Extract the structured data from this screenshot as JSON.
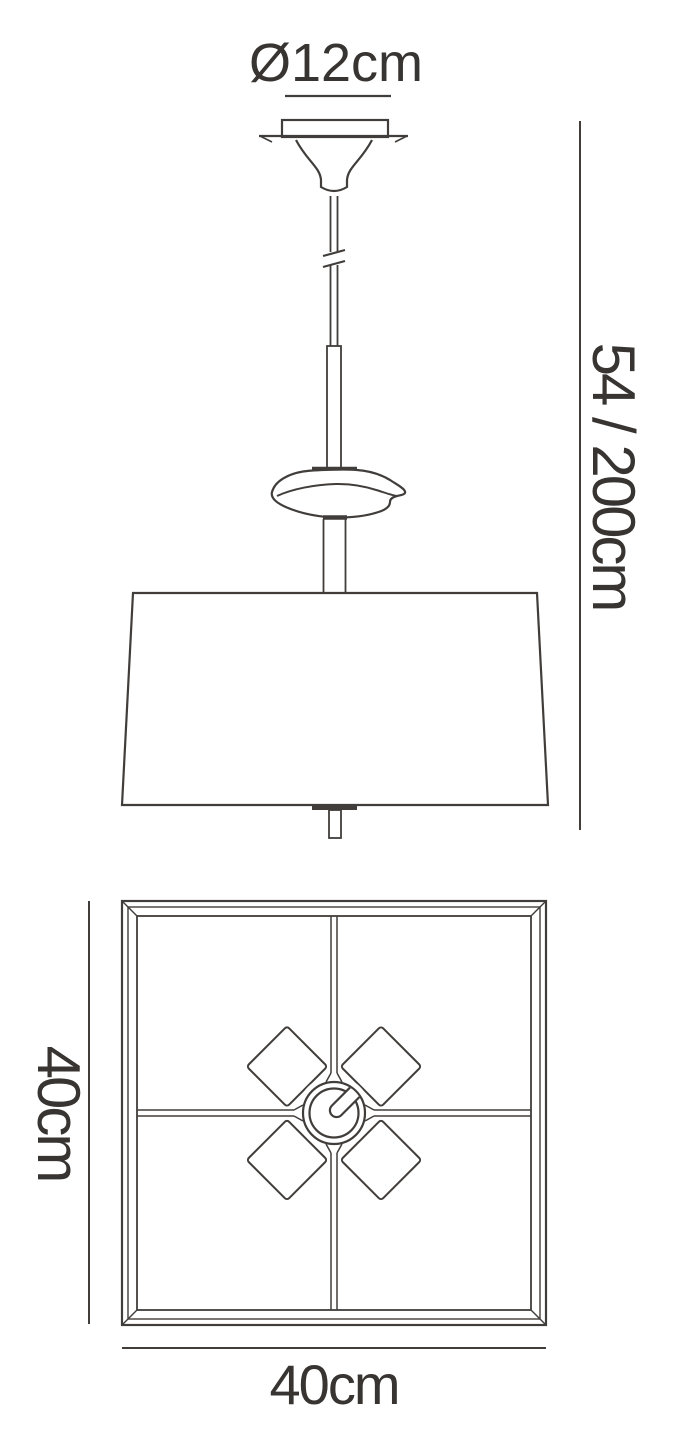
{
  "diagram": {
    "kind": "pendant-lamp-dimension-drawing",
    "labels": {
      "canopy_diameter": "Ø12cm",
      "suspension_height": "54 / 200cm",
      "shade_width": "40cm",
      "shade_depth": "40cm"
    },
    "colors": {
      "line": "#413d3a",
      "text": "#383431",
      "background": "#ffffff"
    }
  }
}
